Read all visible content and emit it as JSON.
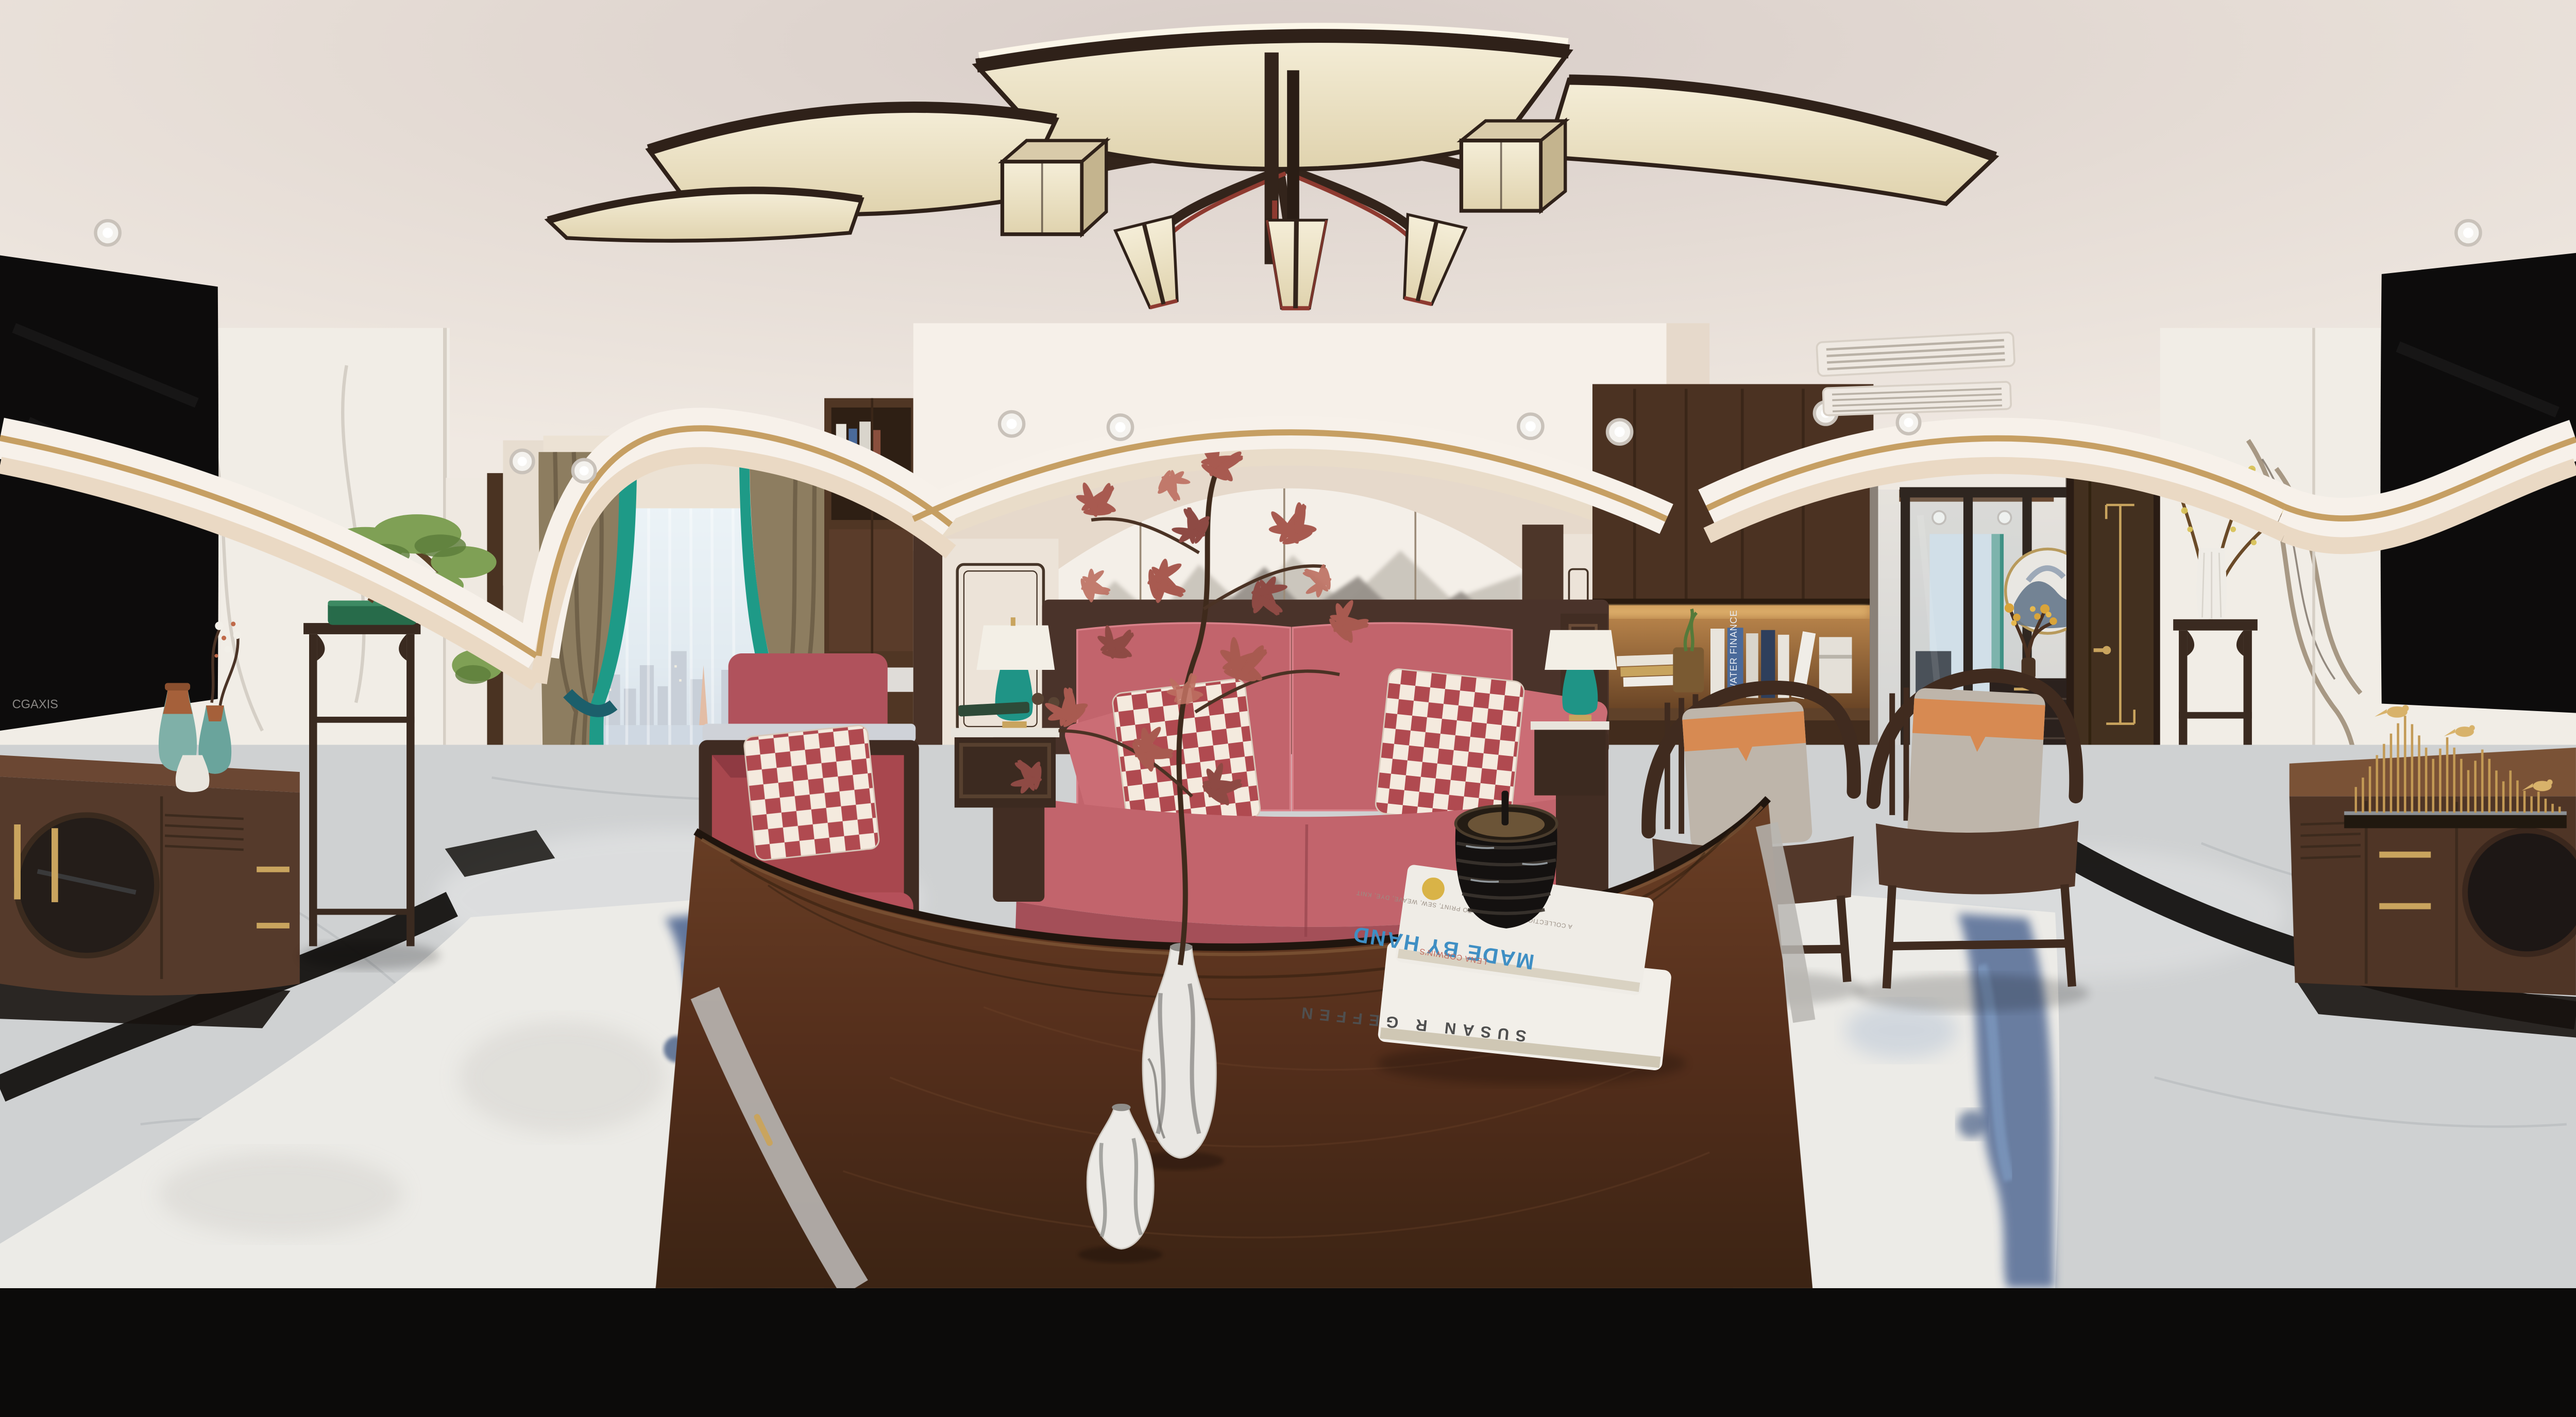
{
  "texts": {
    "book_top_title": "MADE BY HAND",
    "book_top_author": "LENA CORWIN'S",
    "book_top_tagline": "A COLLECTION OF PROJECTS TO PRINT, SEW, WEAVE, DYE, KNIT",
    "book_bottom_spine": "SUSAN R GEFFEN",
    "tv_brand": "CGAXIS",
    "shelf_book_spine": "WATER FINANCE"
  },
  "palette": {
    "ceiling_edge": "#f0e9e2",
    "ceiling_center": "#d8cdc8",
    "gold_trim": "#c69f63",
    "cove_white": "#f7f1ea",
    "wall_beige": "#e6d9cb",
    "mural_bg": "#f4efe8",
    "mural_ink_far": "#c5bfb6",
    "mural_ink_mid": "#97918a",
    "mural_ink_near": "#5d574f",
    "marble_white": "#f1ede6",
    "marble_vein": "#a89e90",
    "wood_dark": "#3a2719",
    "wood_mid": "#56382a",
    "wood_light": "#7a5234",
    "table_wood": "#5e3a24",
    "sofa_pink": "#c2646c",
    "sofa_pink_dark": "#a44f58",
    "pillow_red": "#b04a50",
    "pillow_cream": "#f4eade",
    "teal": "#1f9486",
    "curtain_brown": "#8d7d60",
    "curtain_teal": "#1e9a87",
    "sky": "#cfe0ea",
    "city_blue": "#8c9aac",
    "water": "#9fb0c4",
    "floor_gray": "#cfd1d2",
    "inlay_black": "#141210",
    "rug_white": "#ecebe7",
    "rug_blue": "#48628f",
    "cushion_gray": "#beb5aa",
    "cushion_orange": "#d78a52",
    "brass": "#c9a45e",
    "screen_black": "#0d0c0c",
    "lamp_fabric": "#ece2c8",
    "frame_dark": "#2f2119",
    "accent_red": "#8e3a30",
    "bonsai_green": "#7fa055",
    "pot_green": "#276b4a",
    "book_blue": "#4a6a9a",
    "title_blue": "#3f8fc4"
  }
}
